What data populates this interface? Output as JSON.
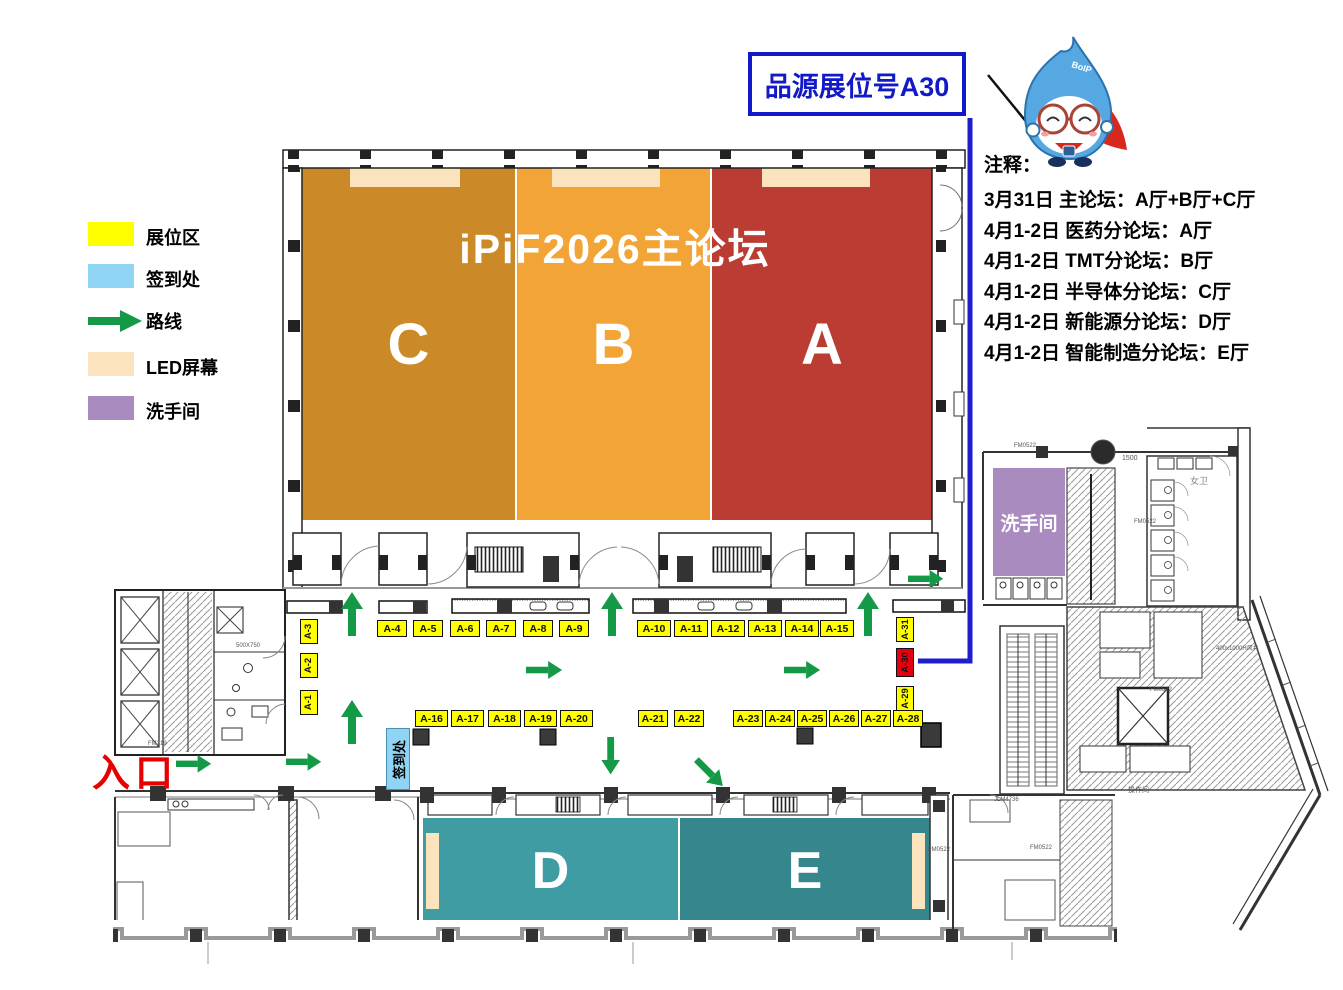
{
  "title": "iPiF2026主论坛",
  "callout": {
    "text": "品源展位号A30"
  },
  "mascot": {
    "badge": "BoIP"
  },
  "notes": {
    "heading": "注释：",
    "lines": [
      "3月31日 主论坛：A厅+B厅+C厅",
      "4月1-2日 医药分论坛：A厅",
      "4月1-2日 TMT分论坛：B厅",
      "4月1-2日 半导体分论坛：C厅",
      "4月1-2日 新能源分论坛：D厅",
      "4月1-2日 智能制造分论坛：E厅"
    ]
  },
  "legend": {
    "items": [
      {
        "label": "展位区",
        "color": "#FFFF00"
      },
      {
        "label": "签到处",
        "color": "#8FD4F2"
      },
      {
        "label": "路线",
        "color": "#149A46"
      },
      {
        "label": "LED屏幕",
        "color": "#FBE3BE"
      },
      {
        "label": "洗手间",
        "color": "#A98BC0"
      }
    ]
  },
  "halls": [
    {
      "label": "C",
      "color": "#CB8A27"
    },
    {
      "label": "B",
      "color": "#F3A436"
    },
    {
      "label": "A",
      "color": "#BB3C33"
    },
    {
      "label": "D",
      "color": "#3E9CA2"
    },
    {
      "label": "E",
      "color": "#35878D"
    }
  ],
  "booths": {
    "left_vertical": [
      "A-3",
      "A-2",
      "A-1"
    ],
    "upper_row_west": [
      "A-4",
      "A-5",
      "A-6",
      "A-7",
      "A-8",
      "A-9"
    ],
    "upper_row_east": [
      "A-10",
      "A-11",
      "A-12",
      "A-13",
      "A-14",
      "A-15"
    ],
    "lower_row_west": [
      "A-16",
      "A-17",
      "A-18",
      "A-19",
      "A-20"
    ],
    "lower_row_east": [
      "A-21",
      "A-22",
      "A-23",
      "A-24",
      "A-25",
      "A-26",
      "A-27",
      "A-28"
    ],
    "right_vertical": [
      "A-31",
      "A-30",
      "A-29"
    ],
    "highlighted": "A-30"
  },
  "markers": {
    "entrance": "入口",
    "signin": "签到处",
    "restroom": "洗手间"
  },
  "colors": {
    "route_arrow": "#149A46",
    "route_line": "#1F1ECB",
    "booth": "#FFFF00",
    "booth_highlight": "#E60012",
    "signin": "#8FD4F2",
    "led": "#FBE3BE",
    "restroom": "#A98BC0",
    "callout_blue": "#1219C8",
    "entrance_red": "#E60000"
  },
  "arch_labels": [
    "女卫",
    "1500",
    "FM0522",
    "FM0522",
    "FM0522",
    "JLM4736",
    "400x1000H风井",
    "操作间",
    "500X750",
    "FM0522",
    "FM0522",
    "FM219"
  ]
}
